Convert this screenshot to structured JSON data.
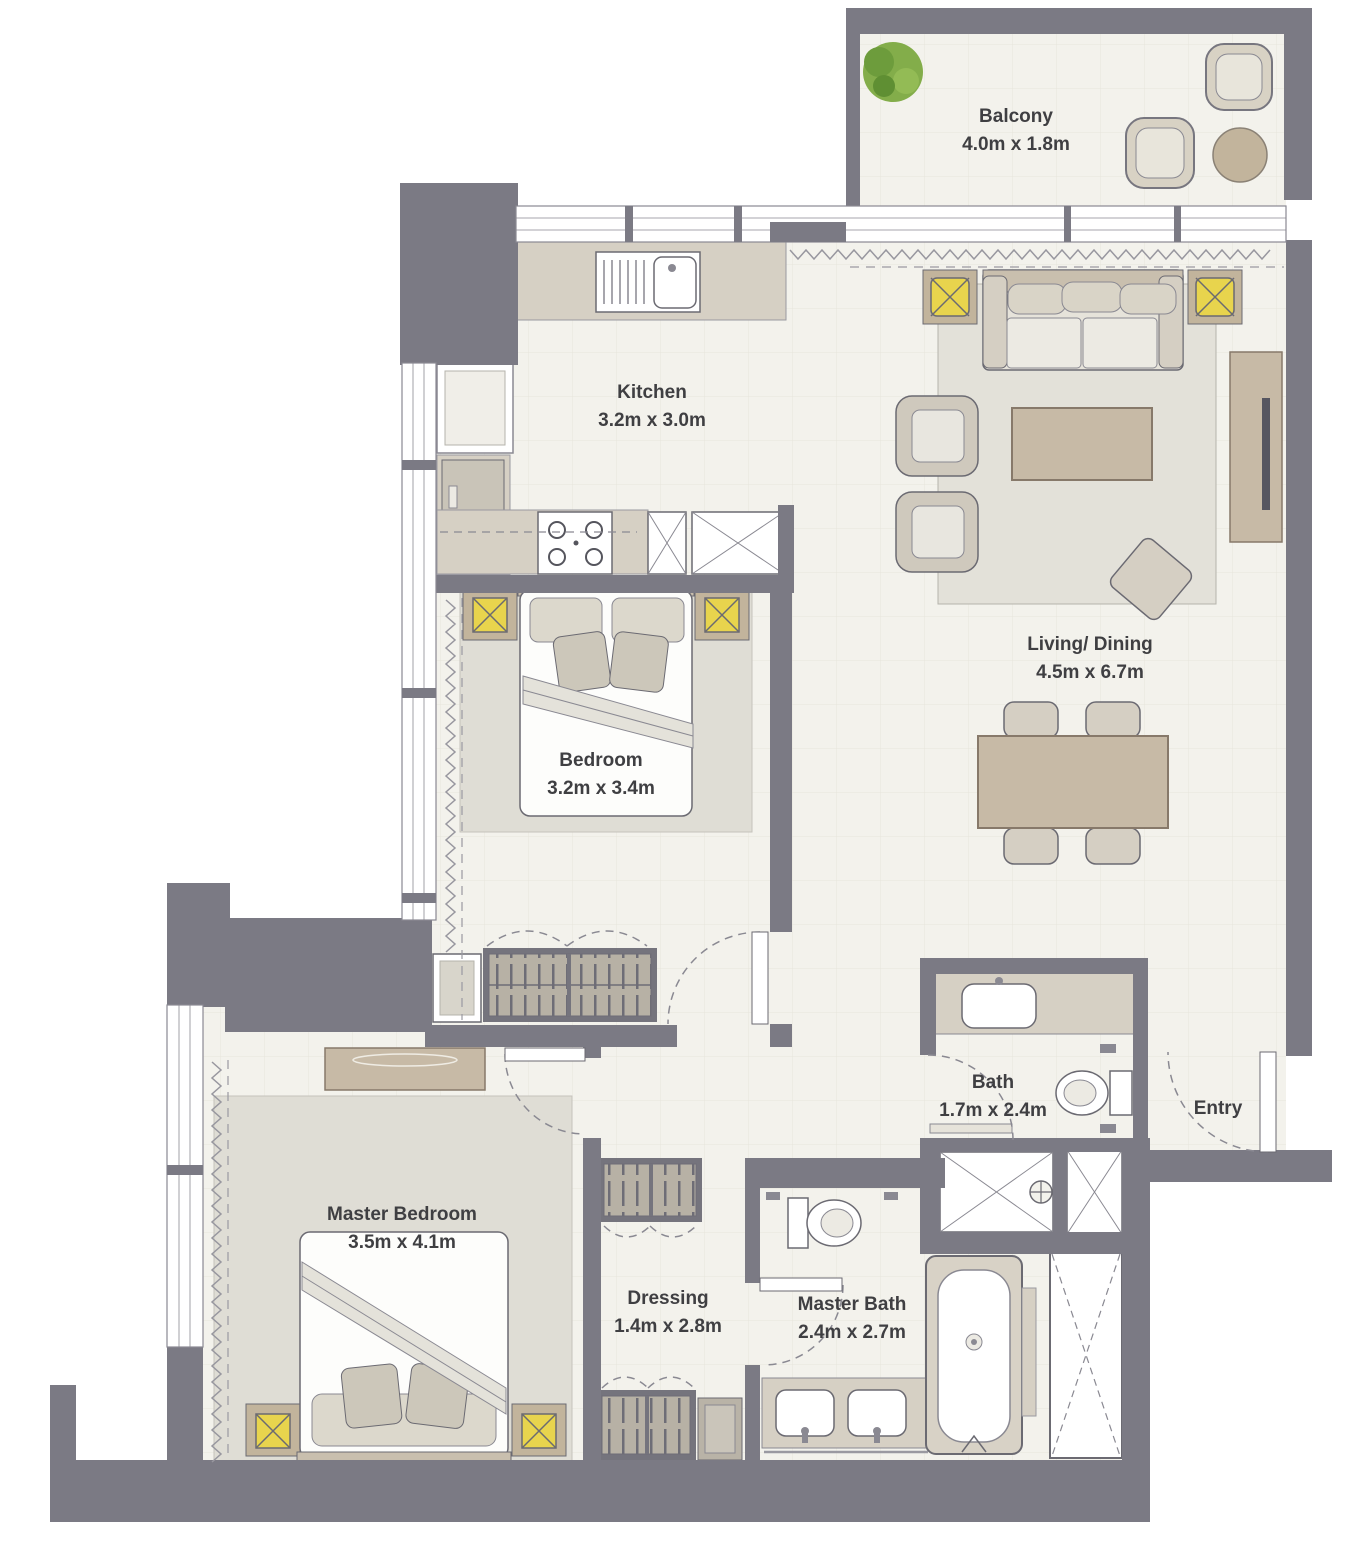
{
  "floorplan": {
    "title": "Apartment floor plan",
    "rooms": {
      "balcony": {
        "name": "Balcony",
        "dims": "4.0m x 1.8m"
      },
      "kitchen": {
        "name": "Kitchen",
        "dims": "3.2m x 3.0m"
      },
      "living_dining": {
        "name": "Living/ Dining",
        "dims": "4.5m x 6.7m"
      },
      "bedroom": {
        "name": "Bedroom",
        "dims": "3.2m x 3.4m"
      },
      "bath": {
        "name": "Bath",
        "dims": "1.7m x 2.4m"
      },
      "entry": {
        "name": "Entry"
      },
      "master_bedroom": {
        "name": "Master Bedroom",
        "dims": "3.5m x 4.1m"
      },
      "dressing": {
        "name": "Dressing",
        "dims": "1.4m x 2.8m"
      },
      "master_bath": {
        "name": "Master Bath",
        "dims": "2.4m x 2.7m"
      }
    },
    "colors": {
      "wall": "#7b7a84",
      "floor": "#f3f2ec",
      "rug": "#dfddd5",
      "furniture_tan": "#c7baa6",
      "counter_tan": "#d6d0c4",
      "accent_yellow": "#e8d44d",
      "plant_green": "#83ad4a"
    }
  }
}
